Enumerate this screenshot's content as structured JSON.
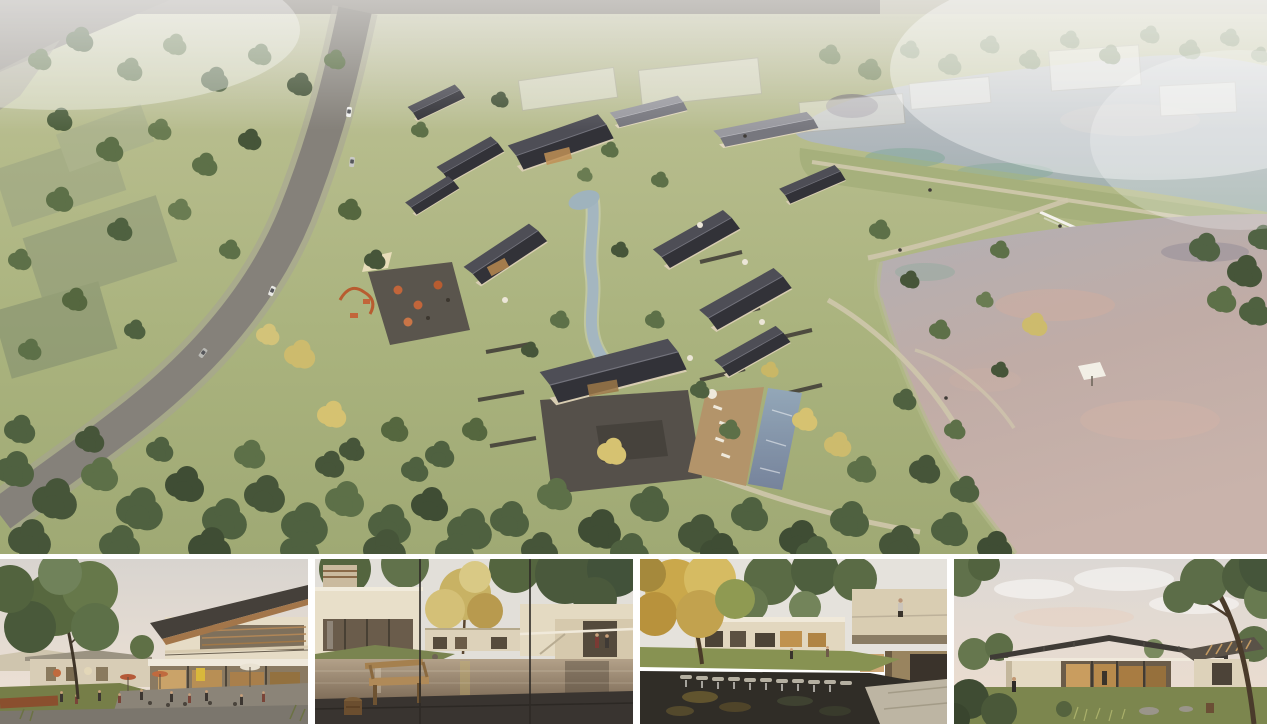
{
  "board": {
    "background": "#ffffff",
    "panels": {
      "aerial": {
        "label": "Aerial rendering of a lakeside village resort with dark pitched-roof houses, winding stream, pool terrace, curving road and two lakes"
      },
      "thumb1": {
        "label": "Street-level rendering of a village cafe plaza with a two-storey timber-roof building, umbrellas and people"
      },
      "thumb2": {
        "label": "Courtyard rendering with reflecting pool, wooden bench on a dark deck and a golden tree"
      },
      "thumb3": {
        "label": "Garden courtyard rendering with koi pond, stone weir, autumn tree and cantilevered balcony"
      },
      "thumb4": {
        "label": "Rendering of a single-storey glass pavilion house with wide dark roof under a hazy dusk sky"
      }
    },
    "palette": {
      "gap_white": "#ffffff",
      "grass": "#aab37e",
      "grass_light": "#c6c8a4",
      "forest_green": "#4f6140",
      "tree_yellow": "#cdbb6d",
      "roof_dark": "#323238",
      "wall_beige": "#d8cdb2",
      "road_grey": "#85817a",
      "lake_grey_blue": "#b4bac0",
      "lake_pink": "#c5afa8",
      "pool_blue": "#8ea2b4",
      "sky_haze": "#e3ddd4",
      "deck_wood": "#b3946a",
      "umbrella_orange": "#c2653a"
    }
  }
}
